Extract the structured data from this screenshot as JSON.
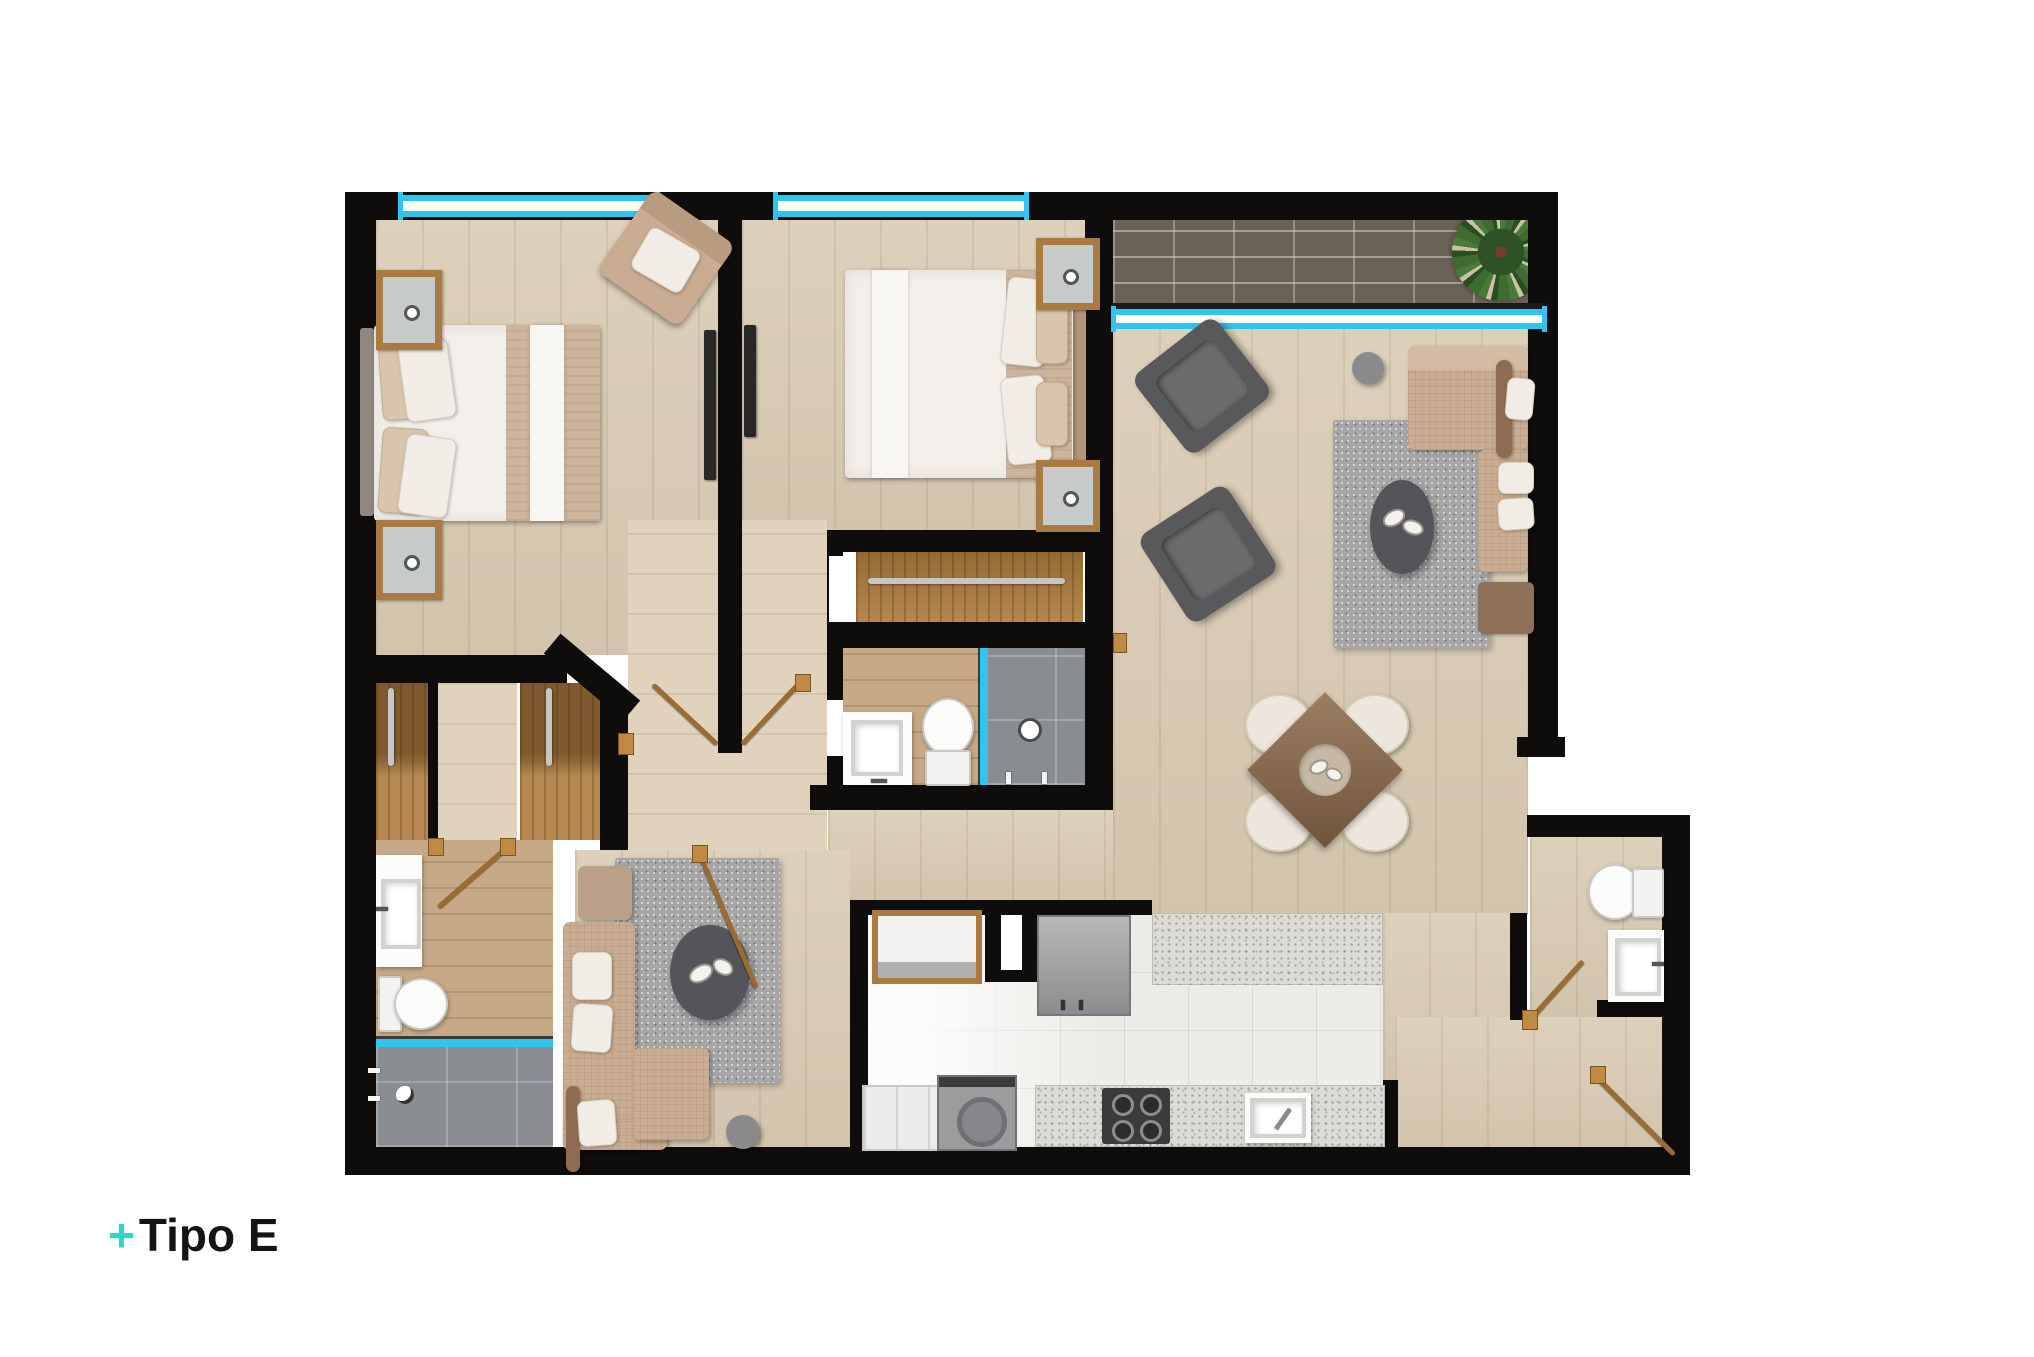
{
  "title": {
    "prefix": "+",
    "text": "Tipo E"
  },
  "colors": {
    "accent_teal": "#2BD8C5",
    "window_cyan": "#30C4F0",
    "wall_black": "#0F0D0B",
    "wood_floor": "#D9CAB2",
    "bath_wood": "#C7A987",
    "closet_wood": "#AE7D3E",
    "shower_tile": "#898D91",
    "kitchen_tile": "#ECEBE7",
    "counter_granite": "#DCDBD6",
    "sofa_beige": "#C9AC91",
    "armchair_gray": "#59595B",
    "rug_gray": "#A6A6A6",
    "dining_table_brown": "#8A6848",
    "brick_gray": "#6B6257",
    "plant_green": "#3C6B2F"
  }
}
